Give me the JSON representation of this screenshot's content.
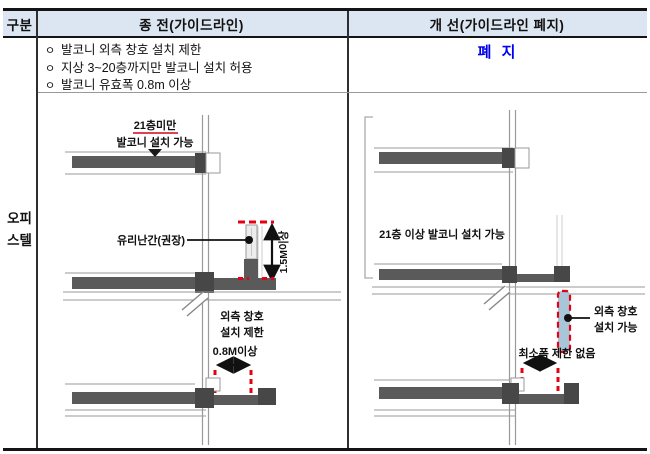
{
  "table": {
    "header": {
      "col_category": "구분",
      "col_before": "종 전(가이드라인)",
      "col_after": "개  선(가이드라인 폐지)"
    },
    "row_label": {
      "line1": "오피",
      "line2": "스텔"
    },
    "before_cell": {
      "bullet_marker": "ㅇ",
      "bullets": [
        "발코니 외측 창호 설치 제한",
        "지상 3~20층까지만 발코니 설치 허용",
        "발코니 유효폭 0.8m 이상"
      ]
    },
    "after_cell": {
      "status": "폐 지"
    }
  },
  "diagram_before": {
    "floor_limit_line1": "21층미만",
    "floor_limit_line2": "발코니 설치 가능",
    "railing_label": "유리난간(권장)",
    "height_label": "1.5M이상",
    "window_restriction_line1": "외측 창호",
    "window_restriction_line2": "설치 제한",
    "min_width_label": "0.8M이상"
  },
  "diagram_after": {
    "floor_label": "21층 이상 발코니 설치 가능",
    "window_allowed_line1": "외측 창호",
    "window_allowed_line2": "설치 가능",
    "min_width_label": "최소폭 제한 없음"
  },
  "colors": {
    "header_bg": "#dce6f2",
    "abolished_text": "#0000ee",
    "dashed_red": "#e60012",
    "slab_gray": "#5a5a5a",
    "beam_gray": "#474747",
    "window_blue": "#a9c5d8",
    "thin_line_gray": "#9a9a9a",
    "border_dark": "#141414"
  }
}
